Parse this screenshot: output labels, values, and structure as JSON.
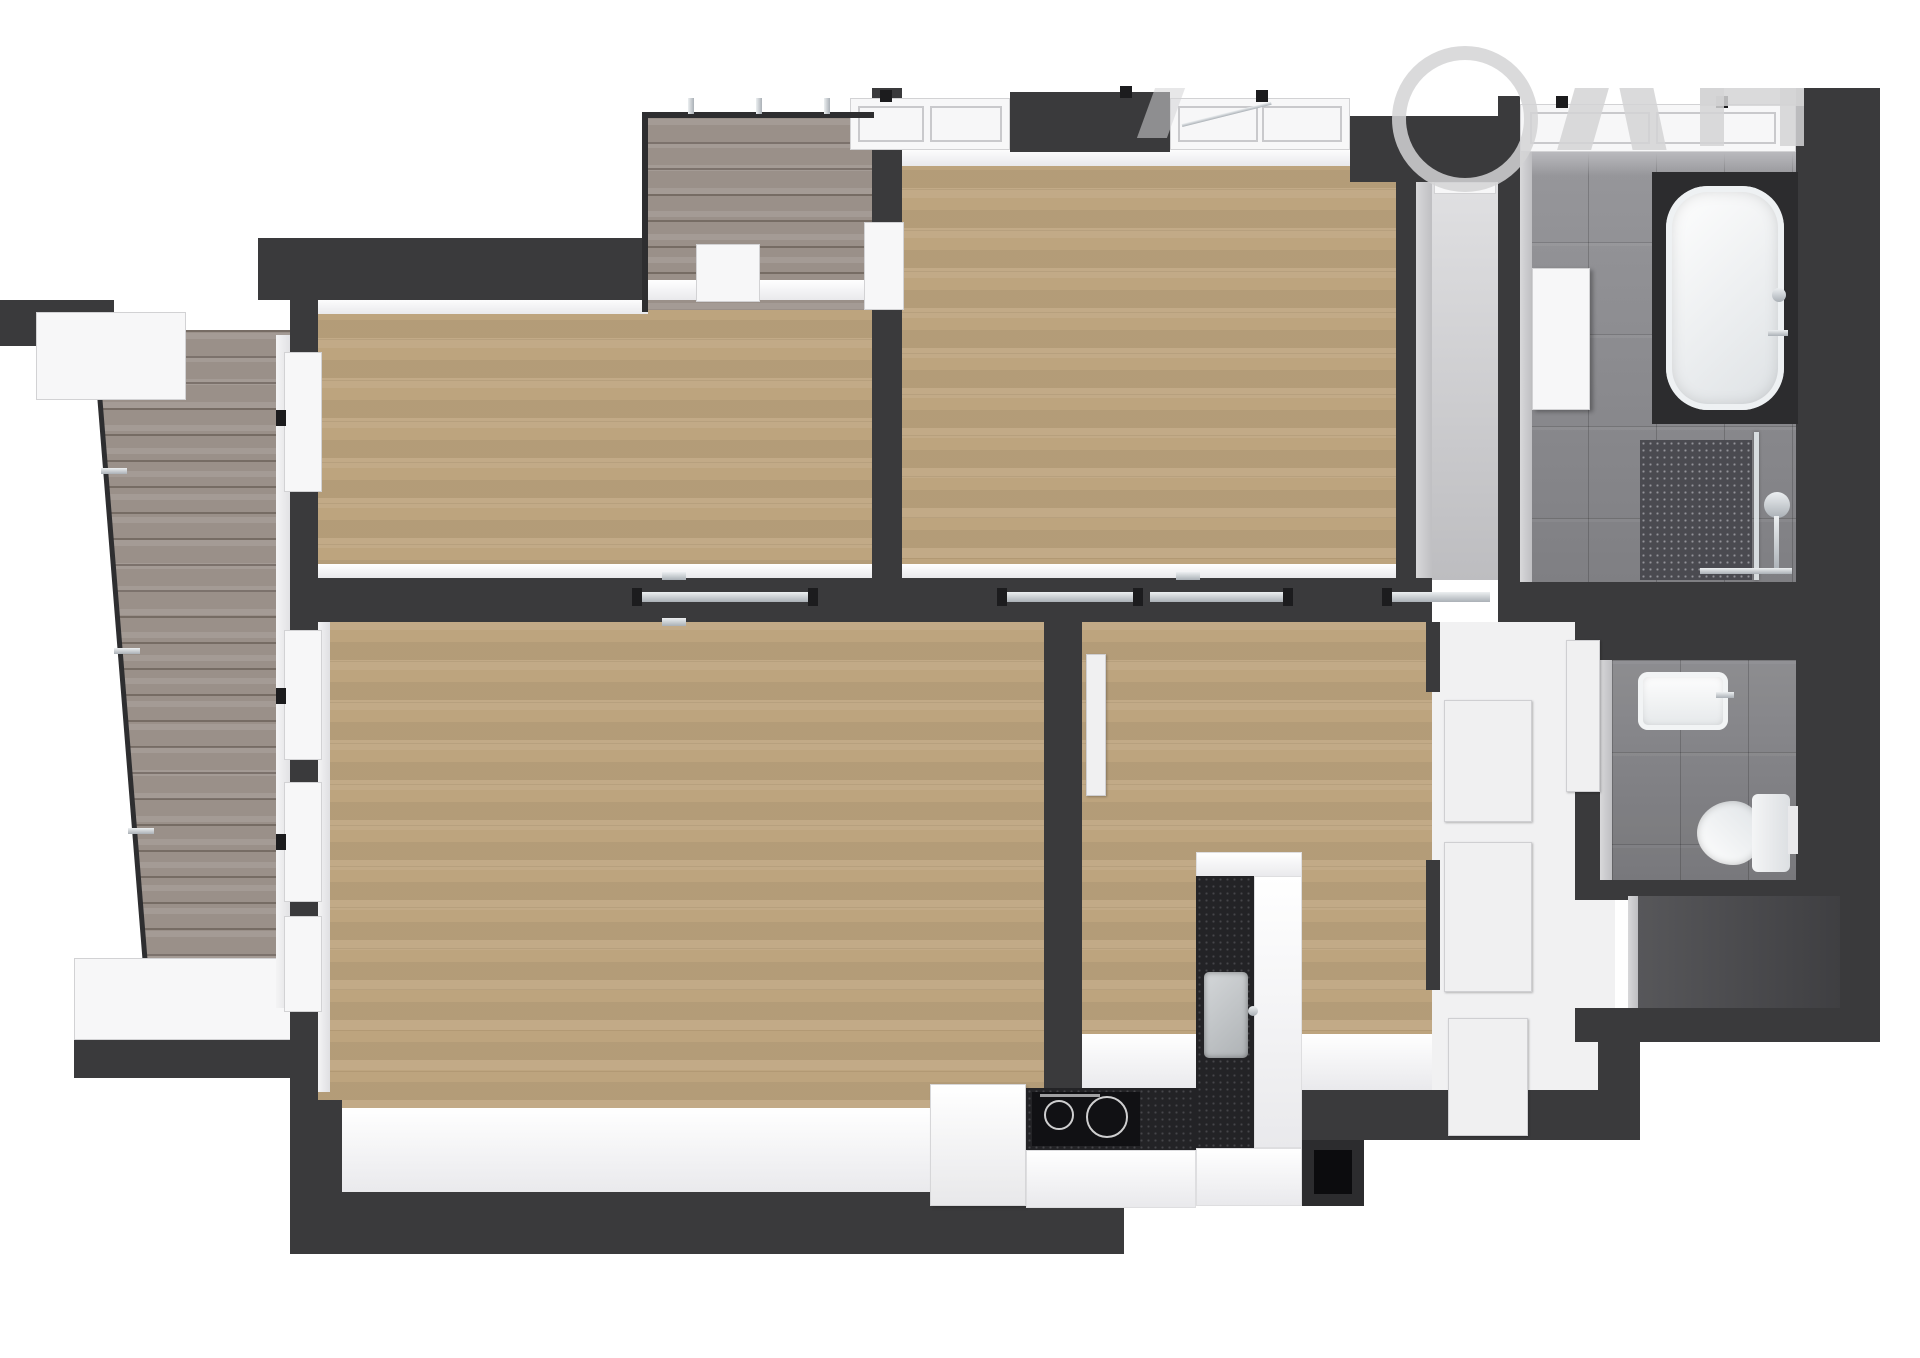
{
  "image": {
    "type": "3d-floor-plan-render",
    "view": "top-down",
    "background": "#ffffff",
    "visible_text": ""
  },
  "colors": {
    "wall": "#3a3a3c",
    "wallDark": "#2c2c2e",
    "wallFace": "#f2f2f3",
    "wallFaceShade": "#c9c9cb",
    "wood": "#bda47e",
    "deck": "#9a9089",
    "tile": "#87878b",
    "corridorFloor": "#c7c7c9",
    "nicheFloor": "#454547",
    "counterBlack": "#232326",
    "chrome": "#c3c7cc",
    "fixtureWhite": "#f7f7f8",
    "watermark": "#d3d3d5"
  },
  "rooms": [
    {
      "name": "bedroom-top-left",
      "floor": "wood"
    },
    {
      "name": "bedroom-top-center",
      "floor": "wood"
    },
    {
      "name": "living-room-with-kitchen",
      "floor": "wood"
    },
    {
      "name": "bedroom-bottom-center",
      "floor": "wood"
    },
    {
      "name": "entry-corridor",
      "floor": "gray"
    },
    {
      "name": "hallway",
      "floor": "white",
      "features": [
        "door-panels"
      ]
    },
    {
      "name": "bathroom",
      "floor": "gray-tile",
      "fixtures": [
        "bathtub",
        "walk-in-shower",
        "wall-cabinet",
        "shower-mixer"
      ]
    },
    {
      "name": "toilet-room",
      "floor": "gray-tile",
      "fixtures": [
        "hand-sink",
        "wall-hung-toilet",
        "flush-plate"
      ]
    },
    {
      "name": "storage-niche",
      "floor": "dark"
    },
    {
      "name": "balcony-left",
      "floor": "gray-deck",
      "features": [
        "glass-railing",
        "white-bench"
      ]
    },
    {
      "name": "balcony-top",
      "floor": "gray-deck",
      "features": [
        "railing-posts",
        "balcony-door"
      ]
    }
  ],
  "kitchen": {
    "fixtures": [
      "tall-cabinet",
      "cooktop-black-glass",
      "inset-sink",
      "l-shaped-black-counter",
      "vent-shaft"
    ]
  },
  "doors": {
    "sliding-track-openings": 4,
    "white-door-leaves": 5,
    "entry-door": 1
  },
  "watermark": {
    "present": true,
    "legible": false
  }
}
